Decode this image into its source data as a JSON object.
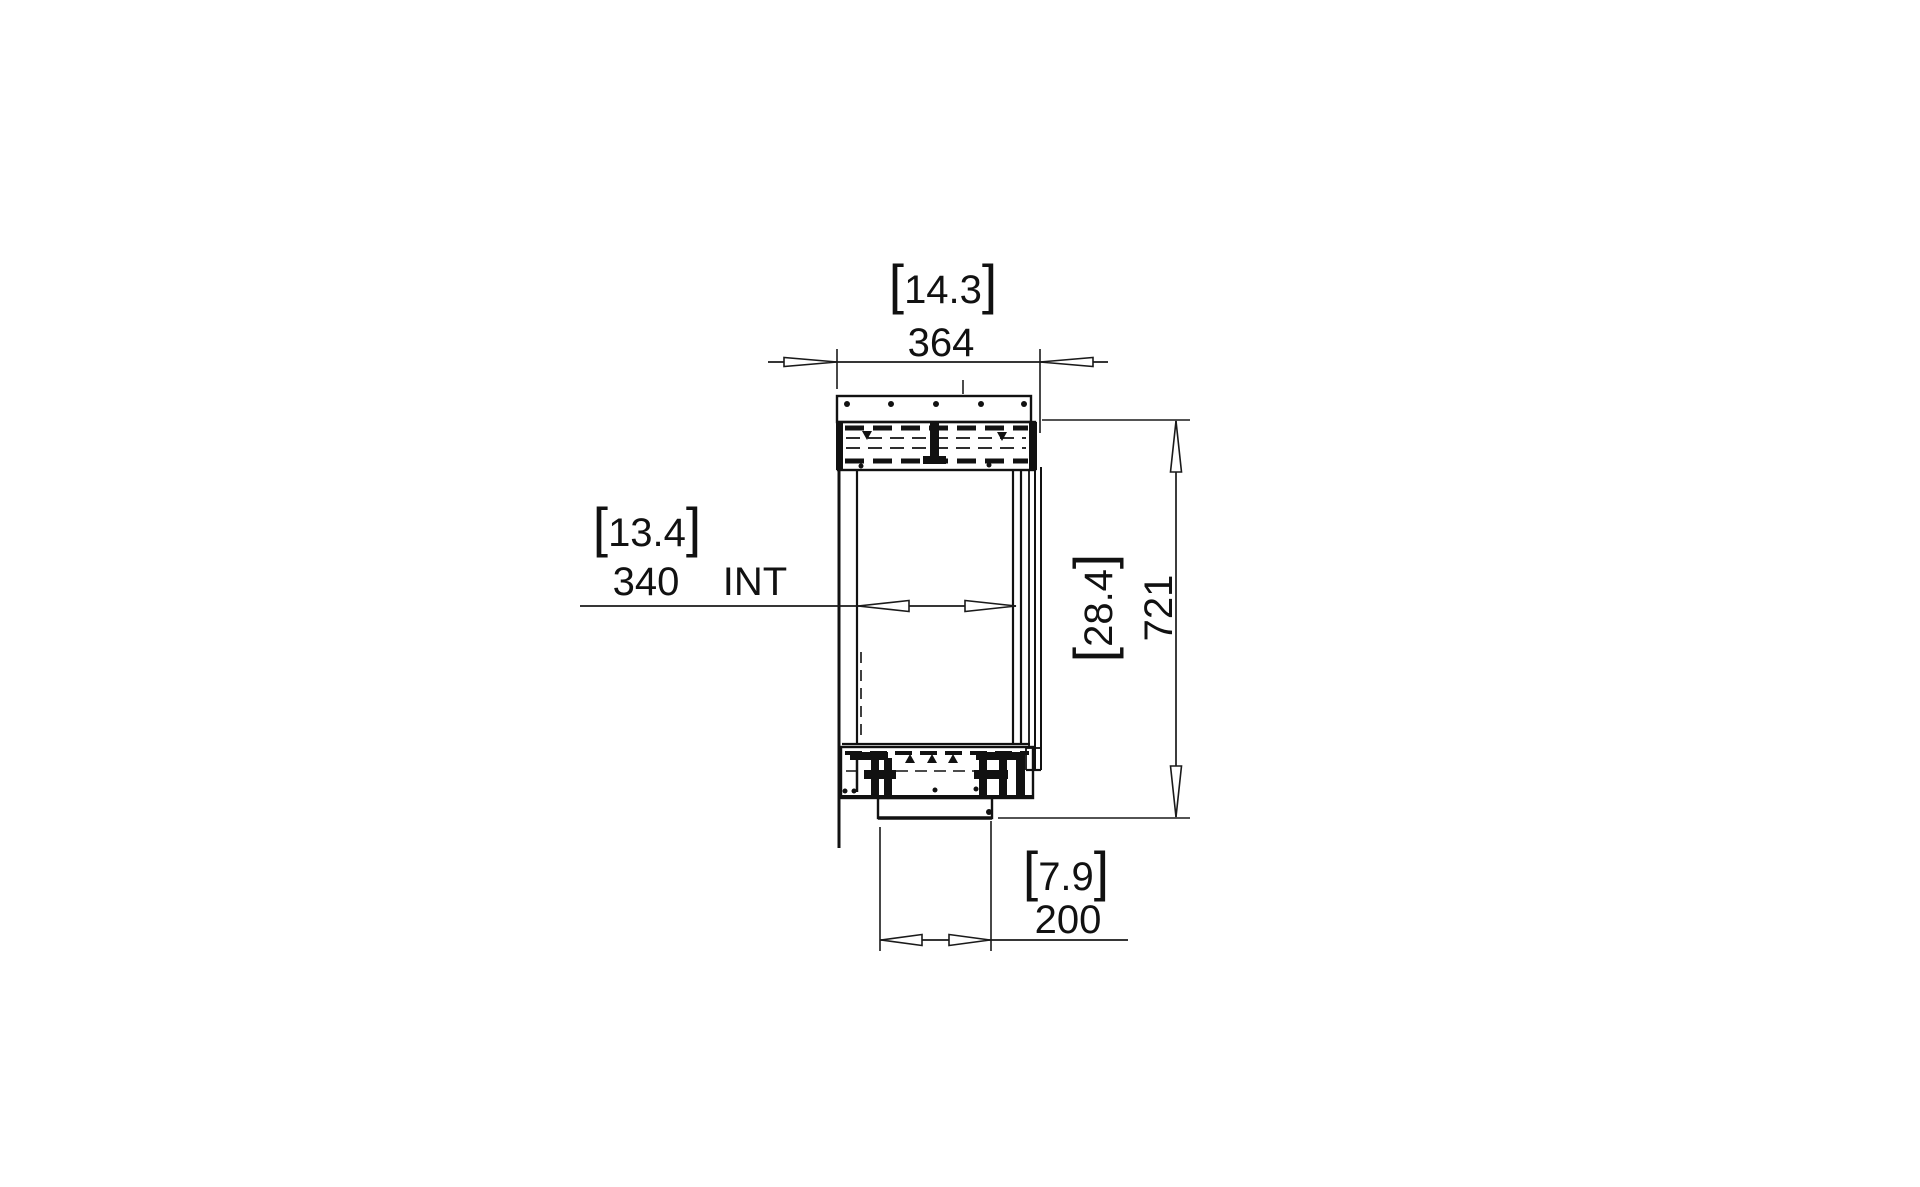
{
  "page": {
    "background": "#ffffff",
    "ink": "#111111"
  },
  "drawing": {
    "type": "technical-section-elevation",
    "brackets": {
      "open": "[",
      "close": "]"
    },
    "dimensions": {
      "top_width": {
        "inches": "14.3",
        "mm": "364"
      },
      "internal_width": {
        "inches": "13.4",
        "mm": "340",
        "label": "INT"
      },
      "overall_height": {
        "inches": "28.4",
        "mm": "721"
      },
      "base_width": {
        "inches": "7.9",
        "mm": "200"
      }
    }
  }
}
